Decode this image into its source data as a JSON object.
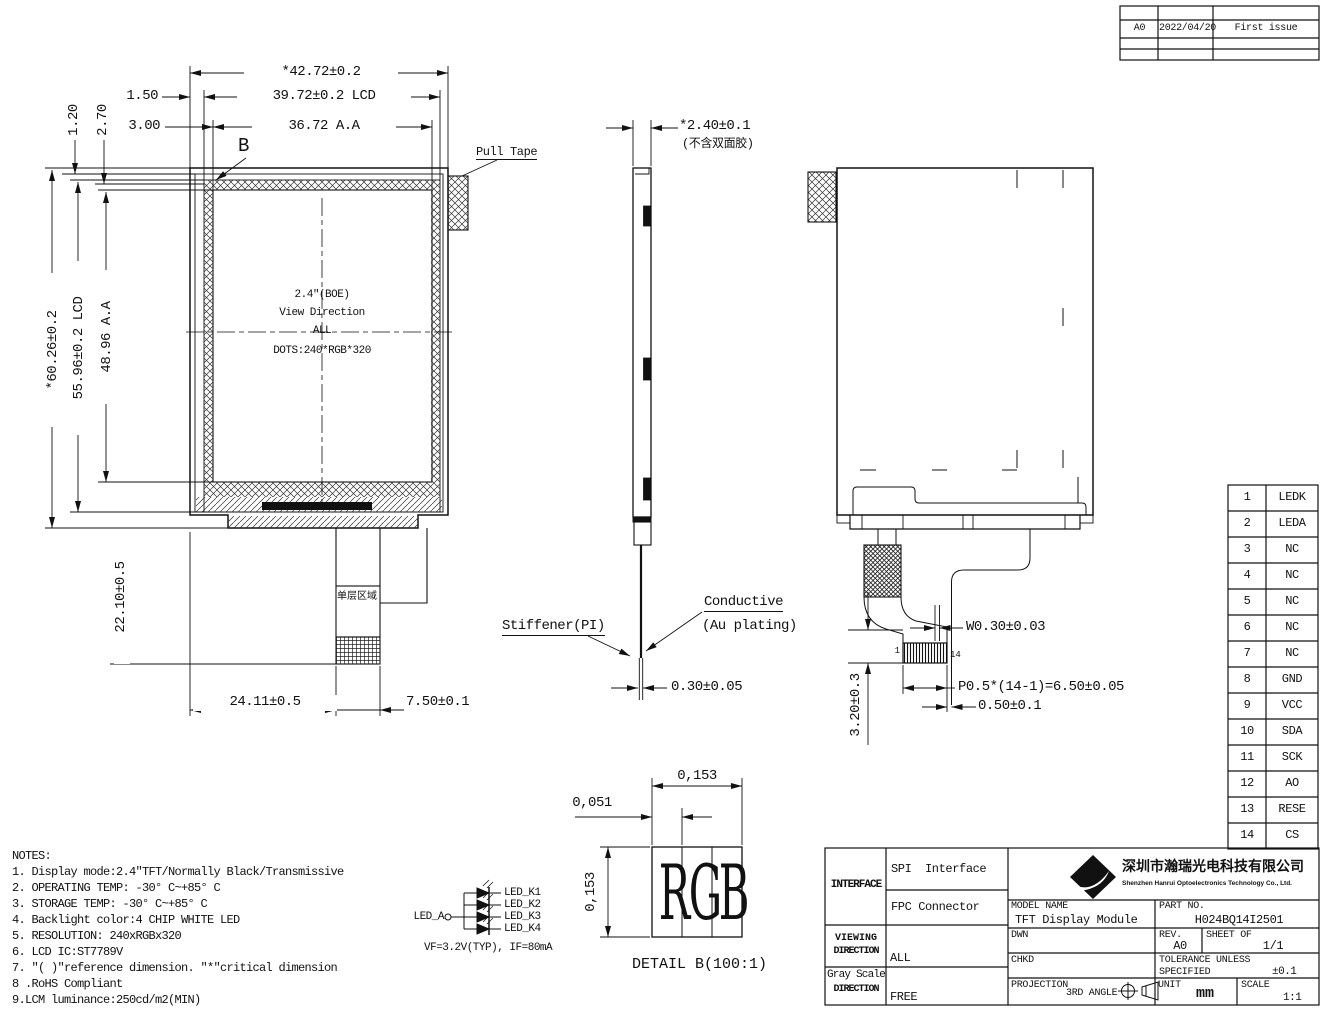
{
  "revision_table": {
    "rev": "A0",
    "date": "2022/04/20",
    "desc": "First issue"
  },
  "front_view": {
    "dim_overall_w": "*42.72±0.2",
    "dim_lcd_w": "39.72±0.2 LCD",
    "dim_aa_w": "36.72 A.A",
    "dim_left_1": "1.50",
    "dim_left_2": "3.00",
    "dim_top_1": "1.20",
    "dim_top_2": "2.70",
    "dim_overall_h": "*60.26±0.2",
    "dim_lcd_h": "55.96±0.2 LCD",
    "dim_aa_h": "48.96 A.A",
    "dim_tail_len": "22.10±0.5",
    "dim_tail_offset": "24.11±0.5",
    "dim_conn_w": "7.50±0.1",
    "pull_tape_label": "Pull Tape",
    "detail_marker": "B",
    "center": [
      "2.4″(BOE)",
      "View Direction",
      "ALL",
      "DOTS:240*RGB*320"
    ],
    "single_layer_label": "单层区域"
  },
  "side_view": {
    "dim_thickness": "*2.40±0.1",
    "thickness_note": "(不含双面胶)",
    "stiffener_label": "Stiffener(PI)",
    "conductive_label_1": "Conductive",
    "conductive_label_2": "(Au plating)",
    "dim_fpc_thickness": "0.30±0.05"
  },
  "back_view": {
    "dim_pin_width": "W0.30±0.03",
    "dim_pitch": "P0.5*(14-1)=6.50±0.05",
    "dim_edge": "0.50±0.1",
    "dim_conn_height": "3.20±0.3",
    "pin_first": "1",
    "pin_last": "14"
  },
  "pin_table": {
    "pins": [
      {
        "no": "1",
        "name": "LEDK"
      },
      {
        "no": "2",
        "name": "LEDA"
      },
      {
        "no": "3",
        "name": "NC"
      },
      {
        "no": "4",
        "name": "NC"
      },
      {
        "no": "5",
        "name": "NC"
      },
      {
        "no": "6",
        "name": "NC"
      },
      {
        "no": "7",
        "name": "NC"
      },
      {
        "no": "8",
        "name": "GND"
      },
      {
        "no": "9",
        "name": "VCC"
      },
      {
        "no": "10",
        "name": "SDA"
      },
      {
        "no": "11",
        "name": "SCK"
      },
      {
        "no": "12",
        "name": "AO"
      },
      {
        "no": "13",
        "name": "RESE"
      },
      {
        "no": "14",
        "name": "CS"
      }
    ]
  },
  "notes": {
    "title": "NOTES:",
    "items": [
      "1. Display mode:2.4″TFT/Normally Black/Transmissive",
      "2. OPERATING TEMP: -30° C~+85° C",
      "3. STORAGE TEMP: -30° C~+85° C",
      "4. Backlight color:4 CHIP WHITE LED",
      "5. RESOLUTION: 240xRGBx320",
      "6. LCD IC:ST7789V",
      "7. ″( )″reference dimension. ″*″critical dimension",
      "8 .RoHS Compliant",
      "9.LCM luminance:250cd/m2(MIN)"
    ]
  },
  "led_circuit": {
    "anode": "LED_A",
    "cathodes": [
      "LED_K1",
      "LED_K2",
      "LED_K3",
      "LED_K4"
    ],
    "spec": "VF=3.2V(TYP), IF=80mA"
  },
  "detail_b": {
    "dim_width": "0,153",
    "dim_subpixel": "0,051",
    "dim_height": "0,153",
    "letters": [
      "R",
      "G",
      "B"
    ],
    "caption": "DETAIL B(100:1)"
  },
  "title_block": {
    "interface_label": "INTERFACE",
    "interface_value_1": "SPI  Interface",
    "interface_value_2": "FPC Connector",
    "viewing_label_1": "VIEWING",
    "viewing_label_2": "DIRECTION",
    "viewing_value": "ALL",
    "grayscale_label_1": "Gray Scale",
    "grayscale_label_2": "DIRECTION",
    "grayscale_value": "FREE",
    "company_cn": "深圳市瀚瑞光电科技有限公司",
    "company_en": "Shenzhen Hanrui Optoelectronics Technology Co., Ltd.",
    "model_label": "MODEL NAME",
    "model_value": "TFT Display Module",
    "part_label": "PART NO.",
    "part_value": "H024BQ14I2501",
    "dwn_label": "DWN",
    "chkd_label": "CHKD",
    "rev_label": "REV.",
    "rev_value": "A0",
    "sheet_label": "SHEET OF",
    "sheet_value": "1/1",
    "tolerance_label_1": "TOLERANCE UNLESS",
    "tolerance_label_2": "SPECIFIED",
    "tolerance_value": "±0.1",
    "projection_label": "PROJECTION",
    "projection_value": "3RD ANGLE",
    "unit_label": "UNIT",
    "unit_value": "mm",
    "scale_label": "SCALE",
    "scale_value": "1:1"
  }
}
